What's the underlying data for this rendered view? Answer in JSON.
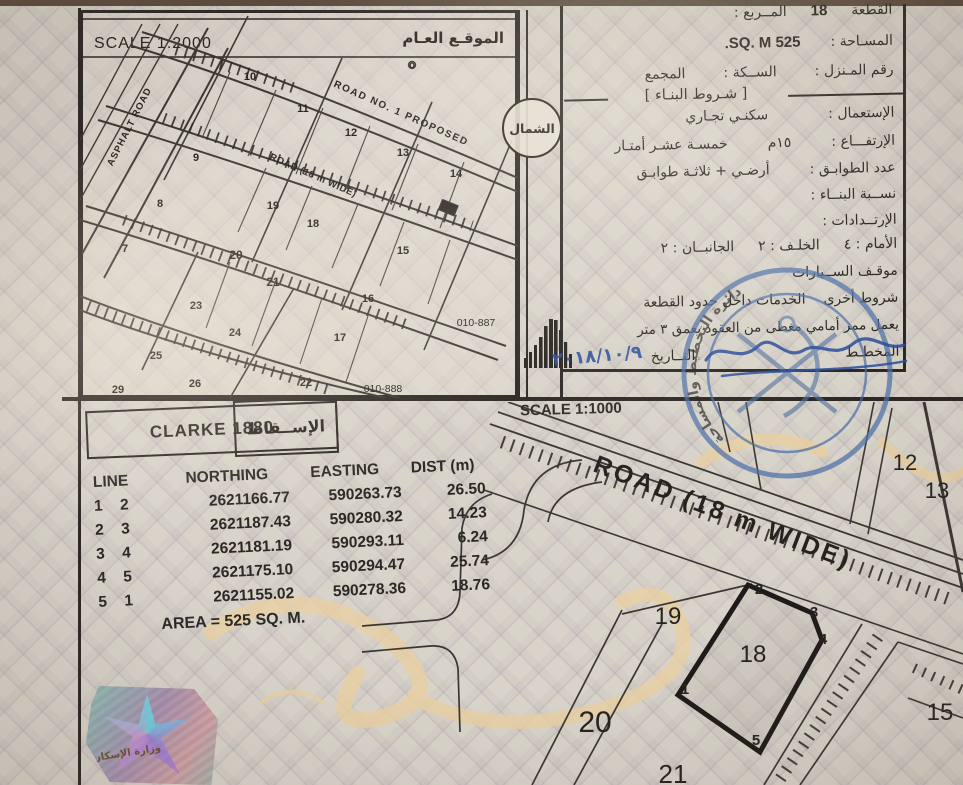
{
  "panel": {
    "plot_label": "القطعة",
    "plot_value": "18",
    "square_label": "المــربع :",
    "area_label": "المسـاحة :",
    "area_value": "525 SQ. M.",
    "house_no_label": "رقم المـنزل :",
    "street_label": "الســكة :",
    "complex_label": "المجمع",
    "conditions_title": "[ شـروط البنـاء ]",
    "use_label": "الإستعمال :",
    "use_value": "سكنـي تجـاري",
    "height_label": "الإرتفـــاع :",
    "height_value_num": "١٥م",
    "height_value_words": "خمسـة عشـر أمتـار",
    "floors_label": "عدد الطوابـق :",
    "floors_value": "أرضـي + ثلاثـة طوابـق",
    "ratio_label": "نســبة البنــاء :",
    "setbacks_label": "الإرتــدادات :",
    "front_label": "الأمام : ٤",
    "back_label": "الخلـف : ٢",
    "sides_label": "الجانبــان : ٢",
    "parking_label": "موقـف الســيارات",
    "other_label": "شروط أخرى",
    "other_value": "الخدمات داخل حدود القطعة",
    "note_line": "يعمل ممر أمامي مغطى من العقود بعمق ٣ متر",
    "planner_label": "المخطـط",
    "date_label": "التــاريخ",
    "date_value": "٢٠١٨/١٠/٩"
  },
  "overview_map": {
    "title": "الموقـع العـام",
    "scale": "SCALE 1:2000",
    "north_label": "الشمال",
    "labels": [
      {
        "t": "10",
        "x": 170,
        "y": 70,
        "s": 11,
        "b": 1
      },
      {
        "t": "11",
        "x": 223,
        "y": 102,
        "s": 11,
        "b": 1
      },
      {
        "t": "12",
        "x": 271,
        "y": 126,
        "s": 11,
        "b": 1
      },
      {
        "t": "13",
        "x": 323,
        "y": 146,
        "s": 11,
        "b": 1
      },
      {
        "t": "14",
        "x": 376,
        "y": 167,
        "s": 11,
        "b": 1
      },
      {
        "t": "9",
        "x": 116,
        "y": 151,
        "s": 11,
        "b": 1
      },
      {
        "t": "8",
        "x": 80,
        "y": 197,
        "s": 11,
        "b": 1
      },
      {
        "t": "19",
        "x": 193,
        "y": 199,
        "s": 11,
        "b": 1
      },
      {
        "t": "18",
        "x": 233,
        "y": 217,
        "s": 11,
        "b": 1
      },
      {
        "t": "7",
        "x": 45,
        "y": 242,
        "s": 11,
        "b": 1
      },
      {
        "t": "20",
        "x": 156,
        "y": 249,
        "s": 12,
        "b": 1
      },
      {
        "t": "21",
        "x": 193,
        "y": 276,
        "s": 12,
        "b": 1
      },
      {
        "t": "15",
        "x": 323,
        "y": 244,
        "s": 11,
        "b": 1
      },
      {
        "t": "23",
        "x": 116,
        "y": 299,
        "s": 11,
        "b": 1
      },
      {
        "t": "24",
        "x": 155,
        "y": 326,
        "s": 11,
        "b": 1
      },
      {
        "t": "16",
        "x": 288,
        "y": 292,
        "s": 11,
        "b": 1
      },
      {
        "t": "17",
        "x": 260,
        "y": 331,
        "s": 11,
        "b": 1
      },
      {
        "t": "25",
        "x": 76,
        "y": 349,
        "s": 11,
        "b": 1
      },
      {
        "t": "26",
        "x": 115,
        "y": 377,
        "s": 11,
        "b": 1
      },
      {
        "t": "22",
        "x": 226,
        "y": 376,
        "s": 11,
        "b": 1
      },
      {
        "t": "29",
        "x": 38,
        "y": 383,
        "s": 11,
        "b": 1
      },
      {
        "t": "o",
        "x": 332,
        "y": 58,
        "s": 10,
        "b": 1
      },
      {
        "t": "010-887",
        "x": 396,
        "y": 316,
        "s": 10.5
      },
      {
        "t": "010-888",
        "x": 303,
        "y": 382,
        "s": 10.5
      },
      {
        "t": "ASPHALT ROAD",
        "x": 52,
        "y": 118,
        "s": 9.5,
        "r": -63,
        "b": 1,
        "ls": 1
      },
      {
        "t": "ROAD NO. 1 PROPOSED",
        "x": 320,
        "y": 106,
        "s": 10,
        "r": 24,
        "b": 1,
        "ls": 1.5
      },
      {
        "t": "ROAD (18 m WIDE)",
        "x": 232,
        "y": 168,
        "s": 9.5,
        "r": 24,
        "b": 1,
        "ls": 0.5
      }
    ]
  },
  "projection": {
    "datum": "CLARKE 1880",
    "label": "الإســقاط"
  },
  "coords_table": {
    "line_header": "LINE",
    "headers": [
      "NORTHING",
      "EASTING",
      "DIST (m)"
    ],
    "rows": [
      [
        "1",
        "2",
        "2621166.77",
        "590263.73",
        "26.50"
      ],
      [
        "2",
        "3",
        "2621187.43",
        "590280.32",
        "14.23"
      ],
      [
        "3",
        "4",
        "2621181.19",
        "590293.11",
        "6.24"
      ],
      [
        "4",
        "5",
        "2621175.10",
        "590294.47",
        "25.74"
      ],
      [
        "5",
        "1",
        "2621155.02",
        "590278.36",
        "18.76"
      ]
    ],
    "area_line": "AREA = 525 SQ. M."
  },
  "detail_map": {
    "scale": "SCALE 1:1000",
    "highlight_plot": "18",
    "labels": [
      {
        "t": "12",
        "x": 843,
        "y": 68,
        "s": 22
      },
      {
        "t": "13",
        "x": 875,
        "y": 96,
        "s": 22
      },
      {
        "t": "19",
        "x": 606,
        "y": 222,
        "s": 24
      },
      {
        "t": "18",
        "x": 691,
        "y": 260,
        "s": 24
      },
      {
        "t": "20",
        "x": 533,
        "y": 330,
        "s": 30
      },
      {
        "t": "15",
        "x": 878,
        "y": 318,
        "s": 24
      },
      {
        "t": "21",
        "x": 611,
        "y": 381,
        "s": 26
      },
      {
        "t": "ROAD (18 m WIDE)",
        "x": 658,
        "y": 118,
        "s": 25,
        "r": 21,
        "ls": 3,
        "b": 1
      }
    ],
    "vertices": [
      {
        "t": "2",
        "x": 697,
        "y": 192
      },
      {
        "t": "3",
        "x": 752,
        "y": 215
      },
      {
        "t": "4",
        "x": 761,
        "y": 242
      },
      {
        "t": "5",
        "x": 694,
        "y": 343
      },
      {
        "t": "1",
        "x": 623,
        "y": 292
      }
    ]
  },
  "stamp": {
    "rim_text": "دائرة التخطيط والمساحة",
    "color": "#4d6fa8"
  },
  "hologram": {
    "text": "وزارة الإسكان"
  }
}
